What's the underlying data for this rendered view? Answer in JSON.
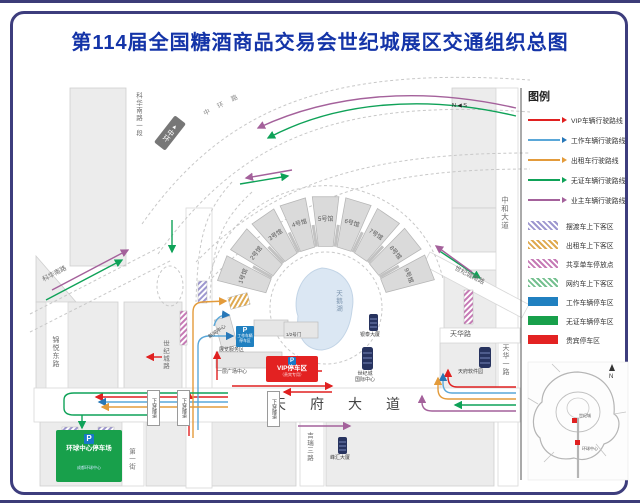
{
  "title": "第114届全国糖酒商品交易会世纪城展区交通组织总图",
  "theme": {
    "title_color": "#1434a8",
    "frame_color": "#3d3d7d"
  },
  "compass": {
    "n": "N",
    "s": "S"
  },
  "legend": {
    "title": "图例",
    "routes": [
      {
        "label": "VIP车辆行驶路线",
        "color": "#e02020"
      },
      {
        "label": "工作车辆行驶路线",
        "color": "#5aa7d8"
      },
      {
        "label": "出租车行驶路线",
        "color": "#e39b3b"
      },
      {
        "label": "无证车辆行驶路线",
        "color": "#0fa258"
      },
      {
        "label": "业主车辆行驶路线",
        "color": "#a4619b"
      }
    ],
    "areas": [
      {
        "label": "摆渡车上下客区",
        "color": "#9d97cf",
        "pattern": "hatch"
      },
      {
        "label": "出租车上下客区",
        "color": "#dfa94f",
        "pattern": "hatch"
      },
      {
        "label": "共享单车停放点",
        "color": "#c67ab5",
        "pattern": "hatch"
      },
      {
        "label": "网约车上下客区",
        "color": "#74c08f",
        "pattern": "hatch"
      },
      {
        "label": "工作车辆停车区",
        "color": "#2080c0",
        "pattern": "solid"
      },
      {
        "label": "无证车辆停车区",
        "color": "#18a04b",
        "pattern": "solid"
      },
      {
        "label": "贵宾停车区",
        "color": "#e32222",
        "pattern": "solid"
      }
    ]
  },
  "map": {
    "roads": {
      "kehua_south_sec1": "科华南路一段",
      "zhonghuan_road": "中环路",
      "zhonghuan_sign": "中环",
      "kehua_south": "科华南路",
      "jinyue_east": "锦悦东路",
      "shijicheng": "世纪城路",
      "shijicheng_south": "世纪城南路",
      "zhonghe_avenue": "中和大道",
      "tianhua": "天华路",
      "tianhua_first": "天华一路",
      "tianfu_avenue": "天府大道",
      "jirui_third": "吉瑞三路",
      "first_street": "第一街",
      "underpass": "下穿隧道"
    },
    "halls": [
      "1号馆",
      "2号馆",
      "3号馆",
      "4号馆",
      "5号馆",
      "6号馆",
      "7号馆",
      "8号馆",
      "9号馆"
    ],
    "lake": "天鹅湖",
    "pois": {
      "news_center": "新闻中心",
      "service_area": "展览服务区",
      "plaza_center": "一层广场中心",
      "gate12": "1/2号门",
      "yintai": "银泰大厦",
      "intl_line1": "世纪城",
      "intl_line2": "国际中心",
      "software_park": "天府软件园",
      "fenghui": "峰汇大厦"
    },
    "parking": {
      "vip": {
        "p": "P",
        "label": "VIP停车区",
        "sub": "（贵宾专用）"
      },
      "work": {
        "p": "P",
        "line1": "工作车辆",
        "line2": "停车区"
      },
      "global": {
        "p": "P",
        "label": "环球中心停车场",
        "brand": "成都环球中心"
      }
    },
    "inset": {
      "marker1": "世纪城",
      "marker2": "环球中心",
      "north": "N"
    }
  }
}
